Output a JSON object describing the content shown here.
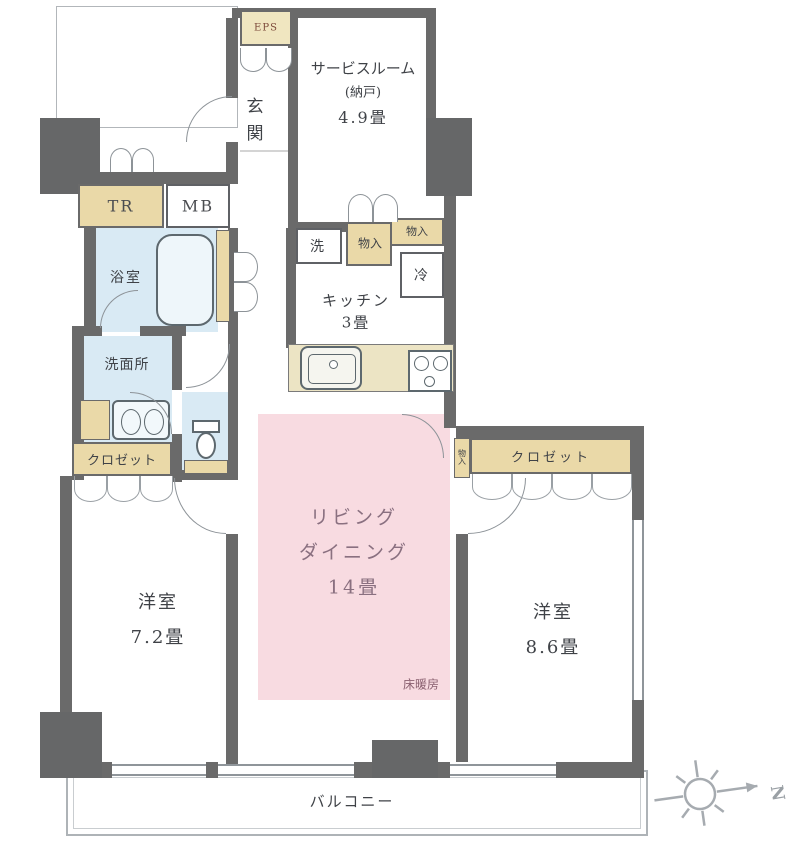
{
  "rooms": {
    "entrance": "玄関",
    "service_room_name": "サービスルーム",
    "service_room_sub": "(納戸)",
    "service_room_size": "4.9畳",
    "kitchen_name": "キッチン",
    "kitchen_size": "3畳",
    "living_line1": "リビング",
    "living_line2": "ダイニング",
    "living_size": "14畳",
    "floor_heating": "床暖房",
    "bathroom": "浴室",
    "washroom": "洗面所",
    "bedroom_left_name": "洋室",
    "bedroom_left_size": "7.2畳",
    "bedroom_right_name": "洋室",
    "bedroom_right_size": "8.6畳",
    "balcony": "バルコニー"
  },
  "boxes": {
    "trunk_room": "TR",
    "meter_box": "MB",
    "eps": "EPS",
    "washer": "洗",
    "fridge": "冷",
    "storage_a": "物入",
    "storage_b": "物入",
    "storage_side": "物入",
    "closet_left": "クロゼット",
    "closet_right": "クロゼット"
  },
  "compass": {
    "north": "N"
  },
  "colors": {
    "wall": "#6a6a6a",
    "wet_area": "#d9eaf4",
    "storage": "#ead9a8",
    "floor_heating_area": "#f8dbe1"
  }
}
